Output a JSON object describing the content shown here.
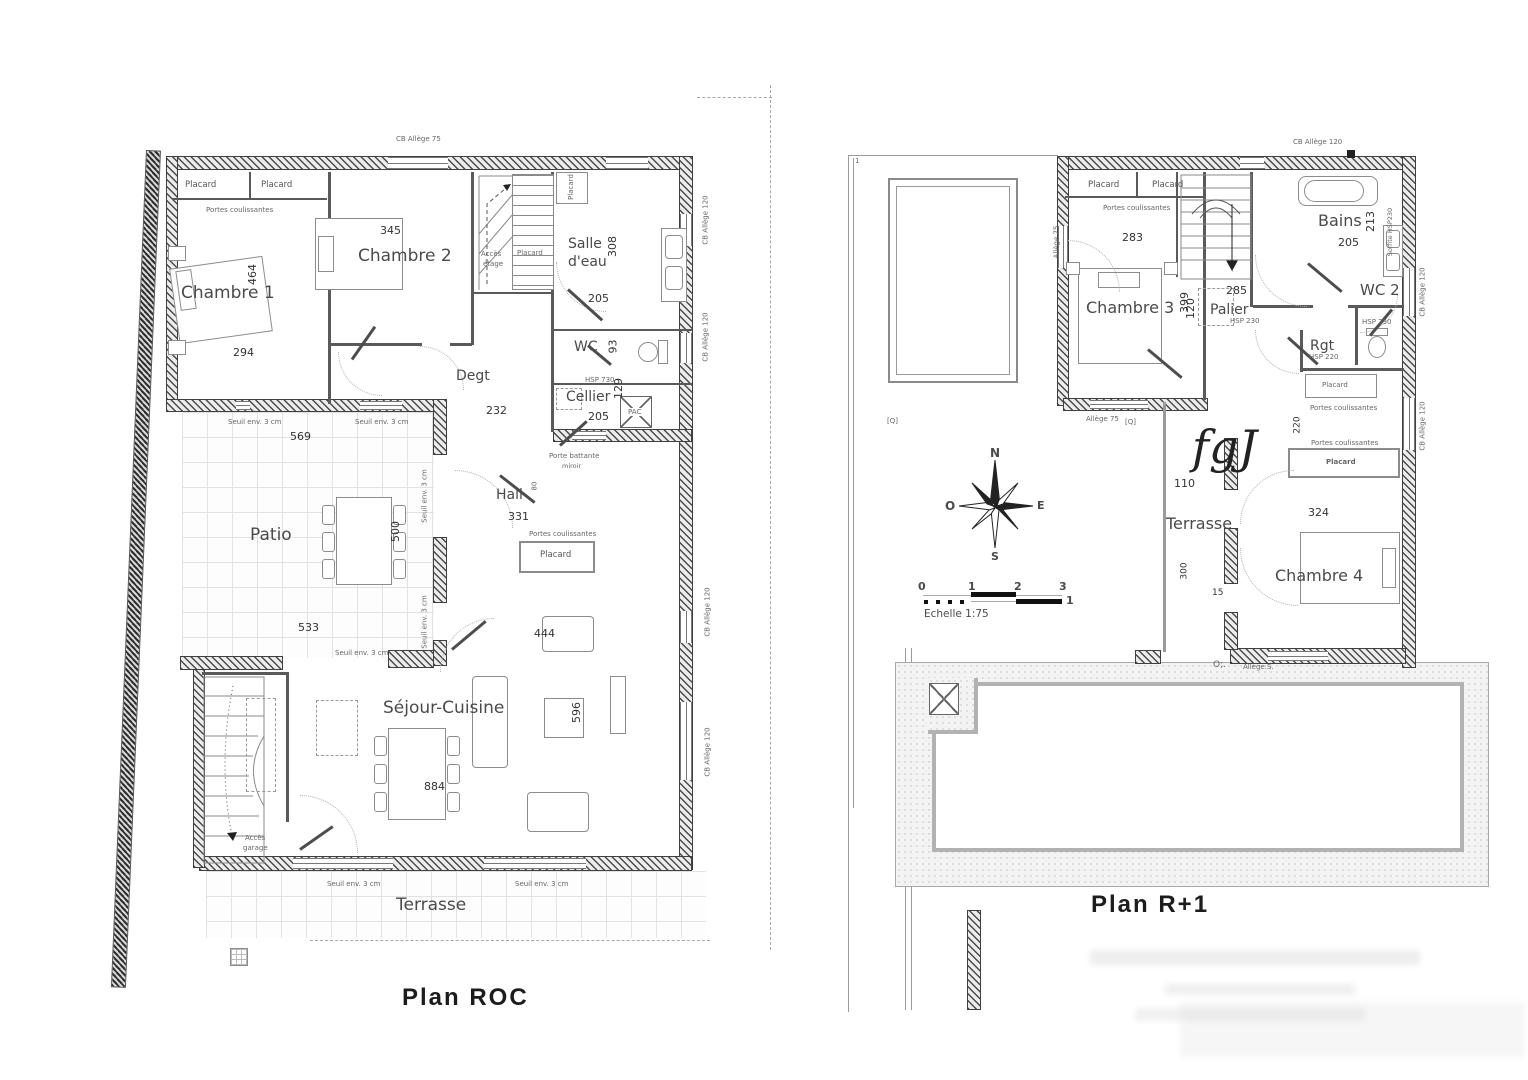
{
  "titles": {
    "left": "Plan ROC",
    "right": "Plan R+1"
  },
  "left": {
    "rooms": {
      "chambre1": "Chambre 1",
      "chambre2": "Chambre 2",
      "salle_deau_1": "Salle",
      "salle_deau_2": "d'eau",
      "wc": "WC",
      "cellier": "Cellier",
      "degt": "Degt",
      "hall": "Hall",
      "patio": "Patio",
      "sejour": "Séjour-Cuisine",
      "terrasse": "Terrasse"
    },
    "annot": {
      "placard": "Placard",
      "portes_coulissantes": "Portes coulissantes",
      "acces_etage_1": "Accès",
      "acces_etage_2": "étage",
      "acces_garage_1": "Accès",
      "acces_garage_2": "garage",
      "porte_battante": "Porte battante",
      "miroir": "miroir",
      "seuil": "Seuil env. 3 cm",
      "hsp730": "HSP 730",
      "pac": "PAC",
      "cb_allege_75": "CB Allège 75",
      "cb_allege_120": "CB Allège 120",
      "door80": "80"
    },
    "dims": {
      "c1_w": "294",
      "c1_h": "464",
      "c2_w": "345",
      "sde_h": "308",
      "sde_w": "205",
      "wc_h": "93",
      "cellier_h": "129",
      "cellier_w": "205",
      "degt": "232",
      "patio_top": "569",
      "patio_bottom": "533",
      "patio_h": "500",
      "hall": "331",
      "sejour_top": "444",
      "sejour_w": "884",
      "sejour_h": "596"
    }
  },
  "right": {
    "rooms": {
      "chambre3": "Chambre 3",
      "bains": "Bains",
      "wc2": "WC 2",
      "palier": "Palier",
      "rgt": "Rgt",
      "terrasse": "Terrasse",
      "chambre4": "Chambre 4"
    },
    "annot": {
      "placard": "Placard",
      "portes_coulissantes": "Portes coulissantes",
      "hsp230": "HSP 230",
      "hsp220": "HSP 220",
      "soffite": "Soffite HSP230",
      "allege75": "Allège 75",
      "allege120": "CB Allège 120",
      "allege_s": "Allège.S.",
      "o_mark": "O;.",
      "q_mark": "[Q]",
      "one": "1",
      "fgj": "fgJ"
    },
    "dims": {
      "c3_w": "283",
      "c3_h": "399",
      "bains_h": "213",
      "bains_w": "205",
      "palier_w": "285",
      "palier_h": "120",
      "c4_w": "324",
      "terr_top": "110",
      "terr_h": "300",
      "small": "15",
      "side": "220"
    },
    "compass": {
      "n": "N",
      "e": "E",
      "s": "S",
      "o": "O"
    },
    "scale": {
      "t0": "0",
      "t1": "1",
      "t2": "2",
      "t3": "3",
      "sub": "1",
      "label": "Echelle 1:75"
    }
  }
}
